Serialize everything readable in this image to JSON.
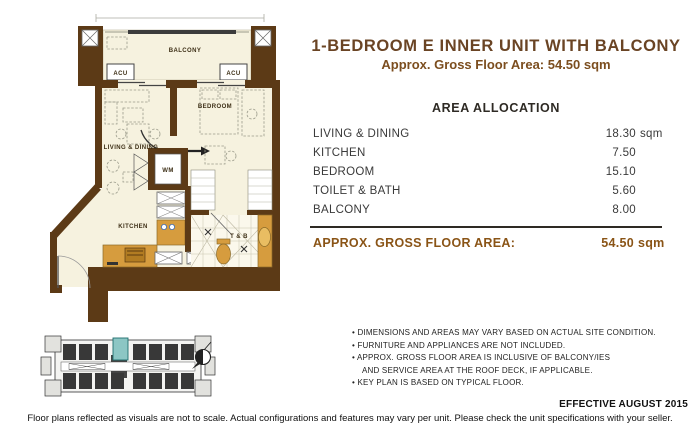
{
  "title": "1-BEDROOM E INNER UNIT WITH BALCONY",
  "subtitle": "Approx. Gross Floor Area: 54.50 sqm",
  "floor_plan": {
    "labels": {
      "balcony": "BALCONY",
      "acu_left": "ACU",
      "acu_right": "ACU",
      "living_dining": "LIVING & DINING",
      "bedroom": "BEDROOM",
      "kitchen": "KITCHEN",
      "wm": "WM",
      "toilet_bath": "T & B"
    },
    "colors": {
      "wall": "#5c3a16",
      "floor": "#f6f2df",
      "fixture_tan": "#d69c3e",
      "keyplan_highlight": "#8cc6c4"
    }
  },
  "area_allocation": {
    "heading": "AREA ALLOCATION",
    "rows": [
      {
        "label": "LIVING & DINING",
        "value": "18.30",
        "unit": "sqm"
      },
      {
        "label": "KITCHEN",
        "value": "7.50",
        "unit": ""
      },
      {
        "label": "BEDROOM",
        "value": "15.10",
        "unit": ""
      },
      {
        "label": "TOILET & BATH",
        "value": "5.60",
        "unit": ""
      },
      {
        "label": "BALCONY",
        "value": "8.00",
        "unit": ""
      }
    ],
    "total_label": "APPROX. GROSS FLOOR AREA:",
    "total_value": "54.50",
    "total_unit": "sqm"
  },
  "notes": {
    "lines": [
      "DIMENSIONS AND AREAS MAY VARY BASED ON ACTUAL SITE CONDITION.",
      "FURNITURE AND APPLIANCES ARE NOT INCLUDED.",
      "APPROX. GROSS FLOOR AREA IS INCLUSIVE OF BALCONY/IES",
      "AND SERVICE AREA AT THE ROOF DECK, IF APPLICABLE.",
      "KEY PLAN IS BASED ON TYPICAL FLOOR."
    ]
  },
  "footer": {
    "effective": "EFFECTIVE AUGUST 2015",
    "disclaimer": "Floor plans reflected as visuals are not to scale. Actual configurations and features may vary per unit. Please check the unit specifications with your seller."
  }
}
